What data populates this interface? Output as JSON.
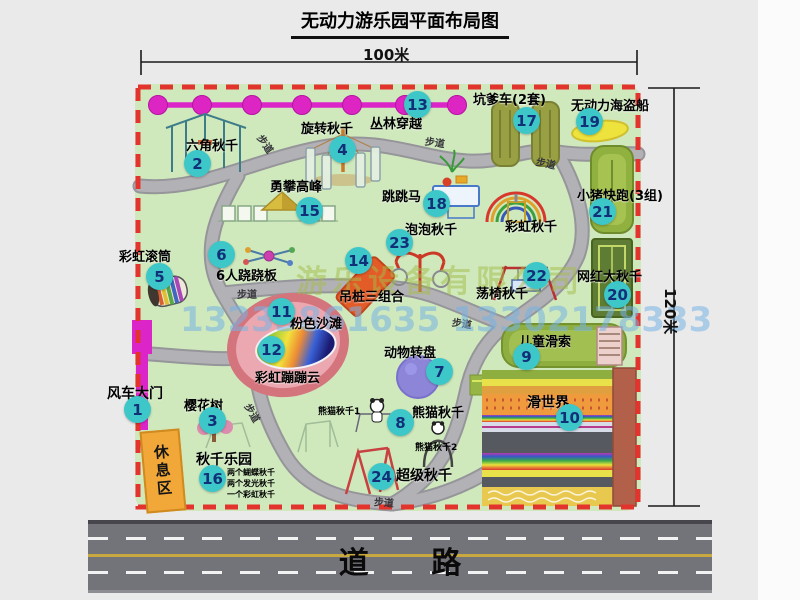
{
  "title": "无动力游乐园平面布局图",
  "dims": {
    "width_label": "100米",
    "height_label": "120米"
  },
  "road": {
    "label": "道 路"
  },
  "watermarks": {
    "company": "游乐设备有限公司",
    "phones": "13233861635 13302178333"
  },
  "rest_area_label": "休息区",
  "path_label": "步道",
  "sub_labels": {
    "rainbow_swing": "彩虹秋千",
    "panda1": "熊猫秋千1",
    "panda2": "熊猫秋千2"
  },
  "swing_notes": [
    "两个蝴蝶秋千",
    "两个发光秋千",
    "一个彩虹秋千"
  ],
  "items": [
    {
      "num": "1",
      "label": "风车大门"
    },
    {
      "num": "2",
      "label": "六角秋千"
    },
    {
      "num": "3",
      "label": "樱花树"
    },
    {
      "num": "4",
      "label": "旋转秋千"
    },
    {
      "num": "5",
      "label": "彩虹滚筒"
    },
    {
      "num": "6",
      "label": "6人跷跷板"
    },
    {
      "num": "7",
      "label": "动物转盘"
    },
    {
      "num": "8",
      "label": "熊猫秋千"
    },
    {
      "num": "9",
      "label": "儿童滑索"
    },
    {
      "num": "10",
      "label": "滑世界"
    },
    {
      "num": "11",
      "label": "粉色沙滩"
    },
    {
      "num": "12",
      "label": "彩虹蹦蹦云"
    },
    {
      "num": "13",
      "label": "丛林穿越"
    },
    {
      "num": "14",
      "label": "吊桩三组合"
    },
    {
      "num": "15",
      "label": "勇攀高峰"
    },
    {
      "num": "16",
      "label": "秋千乐园"
    },
    {
      "num": "17",
      "label": "坑爹车(2套)"
    },
    {
      "num": "18",
      "label": "跳跳马"
    },
    {
      "num": "19",
      "label": "无动力海盗船"
    },
    {
      "num": "20",
      "label": "网红大秋千"
    },
    {
      "num": "21",
      "label": "小猪快跑(3组)"
    },
    {
      "num": "22",
      "label": "荡椅秋千"
    },
    {
      "num": "23",
      "label": "泡泡秋千"
    },
    {
      "num": "24",
      "label": "超级秋千"
    }
  ],
  "colors": {
    "badge": "#3ec7c9",
    "boundary_red": "#e2342c",
    "chain_magenta": "#dc25c8",
    "map_green": "#cfe9bd",
    "road_gray": "#73737a"
  }
}
